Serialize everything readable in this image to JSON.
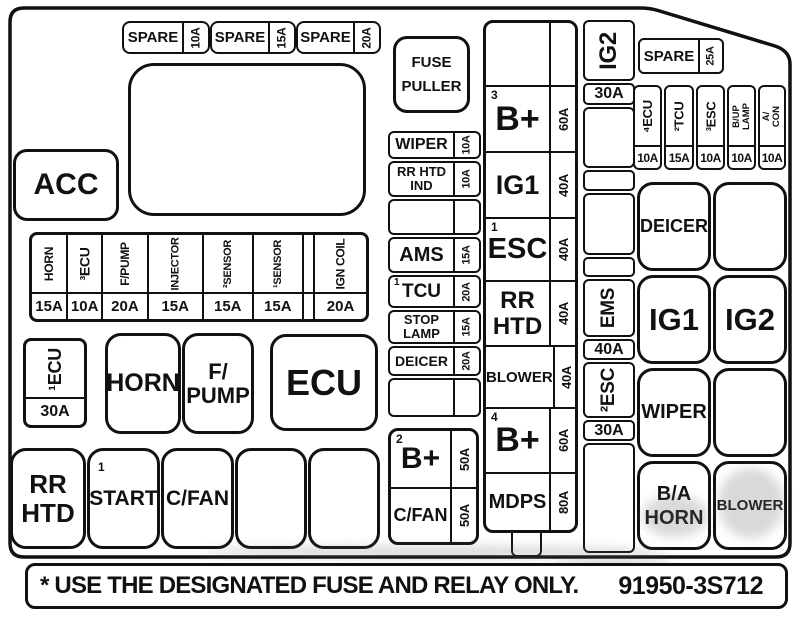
{
  "footer": {
    "note": "* USE THE DESIGNATED FUSE AND RELAY ONLY.",
    "part_number": "91950-3S712"
  },
  "top_spare_fuses": [
    {
      "label": "SPARE",
      "amp": "10A"
    },
    {
      "label": "SPARE",
      "amp": "15A"
    },
    {
      "label": "SPARE",
      "amp": "20A"
    }
  ],
  "fuse_puller": {
    "line1": "FUSE",
    "line2": "PULLER"
  },
  "acc_relay": {
    "label": "ACC"
  },
  "mid_fuse_row": [
    {
      "label": "HORN",
      "amp": "15A"
    },
    {
      "label": "³ECU",
      "amp": "10A"
    },
    {
      "label": "F/PUMP",
      "amp": "20A"
    },
    {
      "label": "INJECTOR",
      "amp": "15A"
    },
    {
      "label": "²SENSOR",
      "amp": "15A"
    },
    {
      "label": "¹SENSOR",
      "amp": "15A"
    },
    {
      "label": "",
      "amp": ""
    },
    {
      "label": "IGN COIL",
      "amp": "20A"
    }
  ],
  "ecu_main_fuse": {
    "label": "¹ECU",
    "amp": "30A"
  },
  "relays": {
    "horn": "HORN",
    "fpump_line1": "F/",
    "fpump_line2": "PUMP",
    "ecu": "ECU",
    "rrhtd_line1": "RR",
    "rrhtd_line2": "HTD",
    "start_sup": "1",
    "start": "START",
    "cfan": "C/FAN"
  },
  "mid_fuse_col": [
    {
      "label": "WIPER",
      "amp": "10A"
    },
    {
      "line1": "RR HTD",
      "line2": "IND",
      "amp": "10A"
    },
    {
      "label": "",
      "amp": ""
    },
    {
      "label": "AMS",
      "amp": "15A"
    },
    {
      "sup": "1",
      "label": "TCU",
      "amp": "20A"
    },
    {
      "line1": "STOP",
      "line2": "LAMP",
      "amp": "15A"
    },
    {
      "label": "DEICER",
      "amp": "20A"
    },
    {
      "label": "",
      "amp": ""
    }
  ],
  "b_plus_cfan": {
    "bplus_sup": "2",
    "bplus": "B+",
    "bplus_amp": "50A",
    "cfan": "C/FAN",
    "cfan_amp": "50A"
  },
  "main_fuse_col": [
    {
      "sup": "",
      "label": "",
      "amp": ""
    },
    {
      "sup": "3",
      "label": "B+",
      "amp": "60A"
    },
    {
      "sup": "",
      "label": "IG1",
      "amp": "40A"
    },
    {
      "sup": "1",
      "label": "ESC",
      "amp": "40A"
    },
    {
      "sup": "",
      "line1": "RR",
      "line2": "HTD",
      "amp": "40A"
    },
    {
      "sup": "",
      "label": "BLOWER",
      "amp": "40A"
    },
    {
      "sup": "4",
      "label": "B+",
      "amp": "60A"
    },
    {
      "sup": "",
      "label": "MDPS",
      "amp": "80A"
    }
  ],
  "ig2_ems_col": {
    "ig2": "IG2",
    "ig2_amp": "30A",
    "ems": "EMS",
    "ems_amp": "40A",
    "esc": "²ESC",
    "esc_amp": "30A"
  },
  "spare_25": {
    "label": "SPARE",
    "amp": "25A"
  },
  "right_fuse_row": [
    {
      "label": "⁴ECU",
      "amp": "10A"
    },
    {
      "label": "²TCU",
      "amp": "15A"
    },
    {
      "label": "³ESC",
      "amp": "10A"
    },
    {
      "line1": "B/UP",
      "line2": "LAMP",
      "amp": "10A"
    },
    {
      "line1": "A/",
      "line2": "CON",
      "amp": "10A"
    }
  ],
  "relay_grid": {
    "deicer": "DEICER",
    "ig1": "IG1",
    "ig2": "IG2",
    "wiper": "WIPER",
    "ba_line1": "B/A",
    "ba_line2": "HORN",
    "blower": "BLOWER"
  }
}
